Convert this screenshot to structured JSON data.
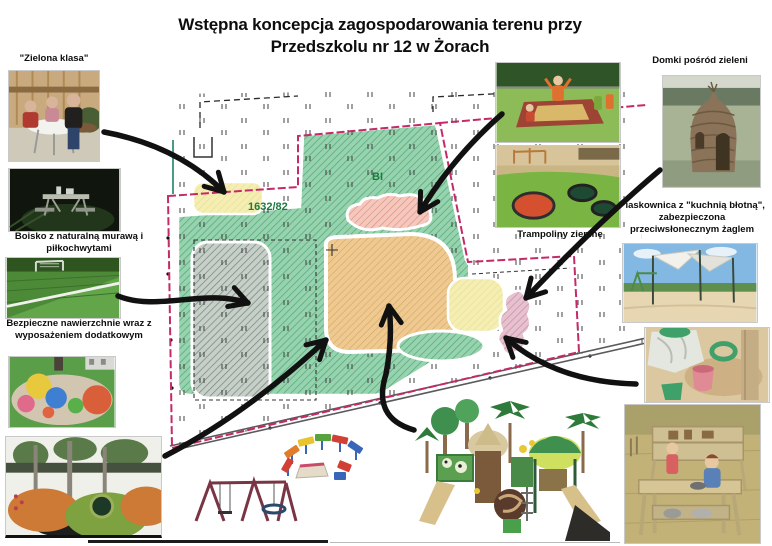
{
  "title": {
    "line1": "Wstępna koncepcja zagospodarowania terenu przy",
    "line2": "Przedszkolu nr 12 w Żorach"
  },
  "map": {
    "zone_label": "BI",
    "parcel_label": "1632/82",
    "colors": {
      "boundary_pink": "#c52a68",
      "green_area": "#97d3ae",
      "tan_area": "#eeca92",
      "pink_area": "#f4c8be",
      "yellow_area": "#f4eeb2",
      "gray_area": "#c6cfc8",
      "purple_area": "#e6c2cf",
      "label_green": "#1d7a3f"
    }
  },
  "photos": {
    "zielona_klasa": {
      "caption": "\"Zielona klasa\""
    },
    "boisko": {
      "caption": "Boisko z naturalną murawą i piłkochwytami"
    },
    "nawierzchnie": {
      "caption": "Bezpieczne nawierzchnie wraz z wyposażeniem dodatkowym"
    },
    "domki": {
      "caption": "Domki pośród zieleni"
    },
    "trampoliny": {
      "caption": "Trampoliny ziemne"
    },
    "piaskownica": {
      "caption": "Piaskownica z \"kuchnią błotną\", zabezpieczona przeciwsłonecznym żaglem"
    }
  }
}
